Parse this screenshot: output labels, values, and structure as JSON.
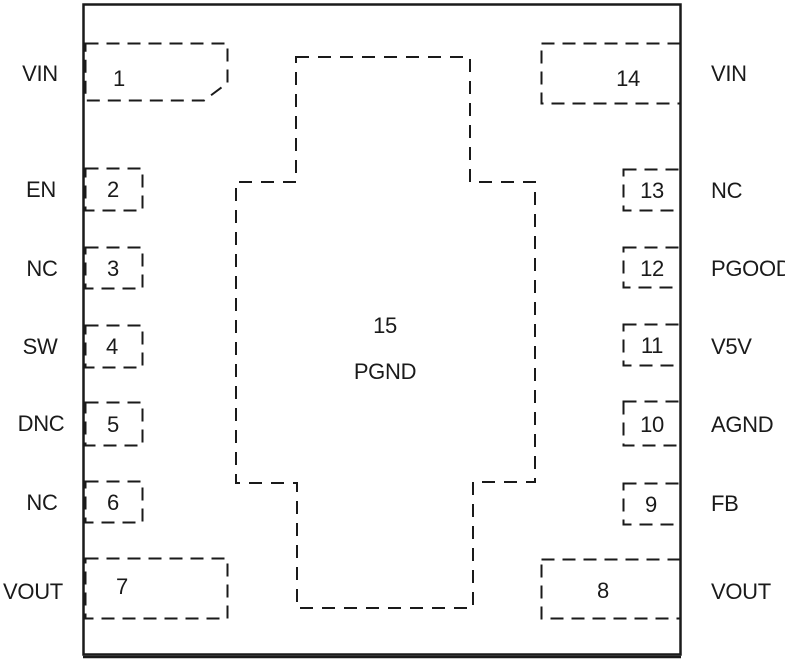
{
  "colors": {
    "line": "#1a1a1a",
    "text": "#1a1a1a",
    "background": "#ffffff"
  },
  "package": {
    "center_pad": {
      "number": "15",
      "name": "PGND"
    },
    "left_pins": [
      {
        "number": "1",
        "name": "VIN"
      },
      {
        "number": "2",
        "name": "EN"
      },
      {
        "number": "3",
        "name": "NC"
      },
      {
        "number": "4",
        "name": "SW"
      },
      {
        "number": "5",
        "name": "DNC"
      },
      {
        "number": "6",
        "name": "NC"
      },
      {
        "number": "7",
        "name": "VOUT"
      }
    ],
    "right_pins": [
      {
        "number": "14",
        "name": "VIN"
      },
      {
        "number": "13",
        "name": "NC"
      },
      {
        "number": "12",
        "name": "PGOOD"
      },
      {
        "number": "11",
        "name": "V5V"
      },
      {
        "number": "10",
        "name": "AGND"
      },
      {
        "number": "9",
        "name": "FB"
      },
      {
        "number": "8",
        "name": "VOUT"
      }
    ]
  }
}
